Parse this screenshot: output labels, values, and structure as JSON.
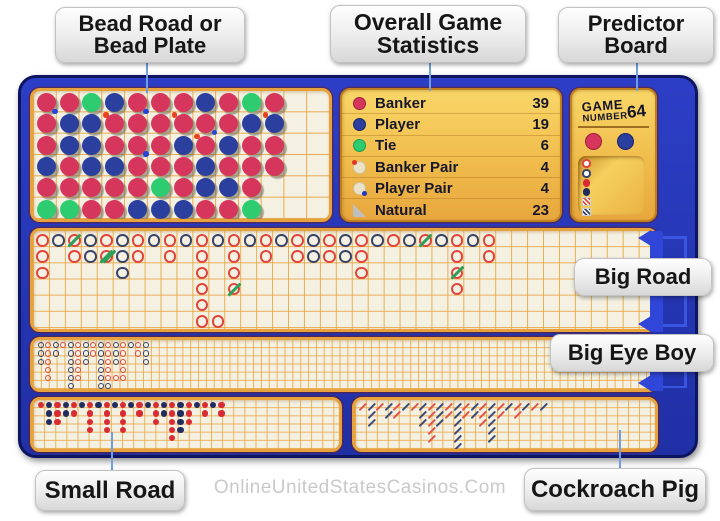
{
  "callouts": {
    "bead": {
      "line1": "Bead Road or",
      "line2": "Bead Plate"
    },
    "stats": {
      "line1": "Overall Game",
      "line2": "Statistics"
    },
    "predictor": {
      "line1": "Predictor",
      "line2": "Board"
    }
  },
  "section_labels": {
    "big_road": "Big Road",
    "big_eye_boy": "Big Eye Boy",
    "small_road": "Small Road",
    "cockroach_pig": "Cockroach Pig"
  },
  "watermark": "OnlineUnitedStatesCasinos.Com",
  "stats": {
    "rows": [
      {
        "icon": "banker",
        "label": "Banker",
        "value": "39"
      },
      {
        "icon": "player",
        "label": "Player",
        "value": "19"
      },
      {
        "icon": "tie",
        "label": "Tie",
        "value": "6"
      },
      {
        "icon": "banker-pair",
        "label": "Banker Pair",
        "value": "4"
      },
      {
        "icon": "player-pair",
        "label": "Player Pair",
        "value": "4"
      },
      {
        "icon": "natural",
        "label": "Natural",
        "value": "23"
      }
    ]
  },
  "predictor": {
    "game_label": "GAME",
    "number_label": "NUMBER",
    "game_number": "64",
    "icons": [
      "banker-ring",
      "player-ring",
      "banker-dot",
      "player-dot",
      "banker-slash-square",
      "player-slash-square"
    ]
  },
  "colors": {
    "banker_red": "#d6365b",
    "player_blue": "#2a3f9e",
    "tie_green": "#2ecc71",
    "road_red": "#e2453a",
    "road_navy": "#3a4468",
    "tie_slash_green": "#2fa05a",
    "panel_cream": "#f4f1e3",
    "grid_orange": "#e8a23c",
    "gold": "#f0bc4c",
    "outer_blue": "#2535b5",
    "bracket_blue": "#2f46d8"
  },
  "bead_plate": {
    "rows": 6,
    "cols": 13,
    "grid": [
      [
        "R",
        "R",
        "G",
        "B",
        "R",
        "R",
        "R",
        "B",
        "R",
        "G",
        "R",
        "",
        ""
      ],
      [
        "R",
        "B",
        "B",
        "R",
        "R",
        "R",
        "R",
        "R",
        "R",
        "B",
        "B",
        "",
        ""
      ],
      [
        "R",
        "B",
        "B",
        "R",
        "R",
        "R",
        "B",
        "R",
        "B",
        "R",
        "R",
        "",
        ""
      ],
      [
        "B",
        "R",
        "B",
        "B",
        "R",
        "R",
        "R",
        "B",
        "R",
        "R",
        "R",
        "",
        ""
      ],
      [
        "R",
        "R",
        "R",
        "R",
        "R",
        "G",
        "R",
        "B",
        "B",
        "R",
        "",
        "",
        ""
      ],
      [
        "G",
        "G",
        "R",
        "R",
        "B",
        "B",
        "B",
        "R",
        "R",
        "G",
        "",
        "",
        ""
      ]
    ],
    "banker_pair_cells": [
      [
        2,
        4
      ],
      [
        2,
        7
      ],
      [
        2,
        11
      ],
      [
        3,
        8
      ]
    ],
    "player_pair_cells": [
      [
        1,
        1
      ],
      [
        1,
        5
      ],
      [
        3,
        5
      ],
      [
        2,
        8
      ]
    ]
  },
  "roads": {
    "big_road": {
      "rows": 6,
      "cols": 39,
      "columns": [
        {
          "v": "R",
          "n": 3
        },
        {
          "v": "P",
          "n": 1
        },
        {
          "v": "R",
          "n": 2,
          "ties": {
            "1": 1
          }
        },
        {
          "v": "P",
          "n": 2
        },
        {
          "v": "R",
          "n": 2,
          "ties": {
            "2": 2
          }
        },
        {
          "v": "P",
          "n": 3
        },
        {
          "v": "R",
          "n": 2
        },
        {
          "v": "P",
          "n": 1
        },
        {
          "v": "R",
          "n": 2
        },
        {
          "v": "P",
          "n": 1
        },
        {
          "v": "R",
          "n": 6
        },
        {
          "v": "P",
          "n": 1
        },
        {
          "v": "R",
          "n": 4,
          "ties": {
            "4": 1
          }
        },
        {
          "v": "P",
          "n": 1
        },
        {
          "v": "R",
          "n": 2
        },
        {
          "v": "P",
          "n": 1
        },
        {
          "v": "R",
          "n": 2
        },
        {
          "v": "P",
          "n": 2
        },
        {
          "v": "R",
          "n": 2
        },
        {
          "v": "P",
          "n": 2
        },
        {
          "v": "R",
          "n": 3
        },
        {
          "v": "P",
          "n": 1
        },
        {
          "v": "R",
          "n": 1
        },
        {
          "v": "P",
          "n": 1
        },
        {
          "v": "R",
          "n": 1,
          "ties": {
            "1": 1
          }
        },
        {
          "v": "P",
          "n": 1
        },
        {
          "v": "R",
          "n": 4,
          "ties": {
            "3": 1
          }
        },
        {
          "v": "P",
          "n": 1
        },
        {
          "v": "R",
          "n": 2
        }
      ],
      "extras": [
        {
          "c": 12,
          "r": 6,
          "v": "R"
        }
      ]
    },
    "big_eye_boy": {
      "rows": 6,
      "cols": 78,
      "columns": [
        {
          "v": "P",
          "n": 3
        },
        {
          "v": "R",
          "n": 5
        },
        {
          "v": "P",
          "n": 2
        },
        {
          "v": "R",
          "n": 1
        },
        {
          "v": "P",
          "n": 6
        },
        {
          "v": "R",
          "n": 5
        },
        {
          "v": "P",
          "n": 3
        },
        {
          "v": "R",
          "n": 2
        },
        {
          "v": "P",
          "n": 6
        },
        {
          "v": "R",
          "n": 5
        },
        {
          "v": "P",
          "n": 3
        },
        {
          "v": "R",
          "n": 4
        },
        {
          "v": "P",
          "n": 1
        },
        {
          "v": "R",
          "n": 2
        },
        {
          "v": "P",
          "n": 3
        }
      ],
      "extras": [
        {
          "c": 10,
          "r": 6,
          "v": "P"
        },
        {
          "c": 11,
          "r": 5,
          "v": "R"
        },
        {
          "c": 12,
          "r": 5,
          "v": "R"
        }
      ]
    },
    "small_road": {
      "rows": 6,
      "cols": 28,
      "columns": [
        {
          "v": "R",
          "n": 1
        },
        {
          "v": "P",
          "n": 3
        },
        {
          "v": "R",
          "n": 3
        },
        {
          "v": "P",
          "n": 2
        },
        {
          "v": "R",
          "n": 2
        },
        {
          "v": "P",
          "n": 1
        },
        {
          "v": "R",
          "n": 4
        },
        {
          "v": "P",
          "n": 1
        },
        {
          "v": "R",
          "n": 4
        },
        {
          "v": "P",
          "n": 1
        },
        {
          "v": "R",
          "n": 4
        },
        {
          "v": "P",
          "n": 1
        },
        {
          "v": "R",
          "n": 2
        },
        {
          "v": "P",
          "n": 1
        },
        {
          "v": "R",
          "n": 3
        },
        {
          "v": "P",
          "n": 2
        },
        {
          "v": "R",
          "n": 5
        },
        {
          "v": "P",
          "n": 4
        },
        {
          "v": "R",
          "n": 3
        },
        {
          "v": "P",
          "n": 1
        },
        {
          "v": "R",
          "n": 2
        },
        {
          "v": "P",
          "n": 1
        },
        {
          "v": "R",
          "n": 2
        }
      ],
      "extras": []
    },
    "cockroach_pig": {
      "rows": 6,
      "cols": 28,
      "columns": [
        {
          "v": "R",
          "n": 1
        },
        {
          "v": "P",
          "n": 3
        },
        {
          "v": "R",
          "n": 1
        },
        {
          "v": "P",
          "n": 2
        },
        {
          "v": "R",
          "n": 2
        },
        {
          "v": "P",
          "n": 1
        },
        {
          "v": "R",
          "n": 1
        },
        {
          "v": "P",
          "n": 3
        },
        {
          "v": "R",
          "n": 5
        },
        {
          "v": "P",
          "n": 3
        },
        {
          "v": "R",
          "n": 2
        },
        {
          "v": "P",
          "n": 6
        },
        {
          "v": "R",
          "n": 2
        },
        {
          "v": "P",
          "n": 2
        },
        {
          "v": "R",
          "n": 3
        },
        {
          "v": "P",
          "n": 5
        },
        {
          "v": "R",
          "n": 2
        },
        {
          "v": "P",
          "n": 1
        },
        {
          "v": "R",
          "n": 2
        },
        {
          "v": "P",
          "n": 1
        },
        {
          "v": "R",
          "n": 1
        },
        {
          "v": "P",
          "n": 1
        }
      ],
      "extras": []
    }
  }
}
